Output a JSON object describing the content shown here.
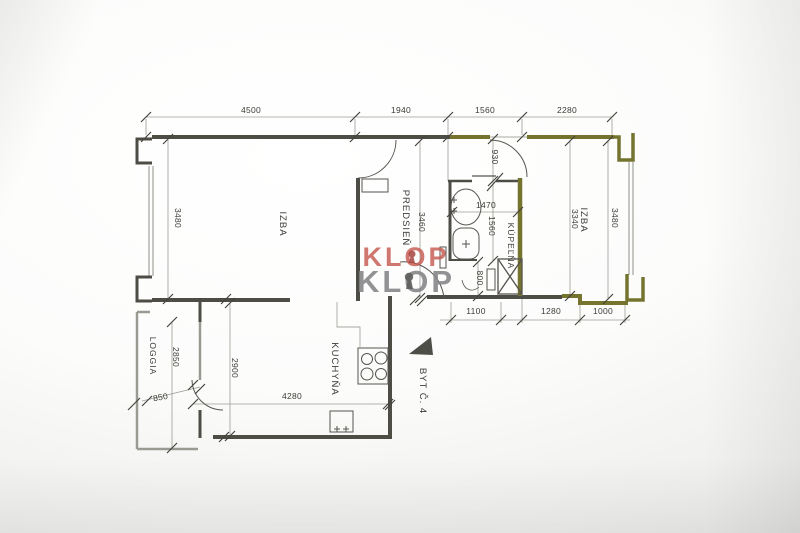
{
  "plan": {
    "unit_label": "BYT Č. 4",
    "rooms": {
      "izba_left": "IZBA",
      "predsien": "PREDSIEŇ",
      "kupelna": "KÚPEĽŇA",
      "izba_right": "IZBA",
      "kuchyna": "KUCHYŇA",
      "loggia": "LOGGIA"
    },
    "dimensions": {
      "top_4500": "4500",
      "top_1940": "1940",
      "top_1560": "1560",
      "top_2280": "2280",
      "left_3480": "3480",
      "predsien_3460": "3460",
      "bath_930": "930",
      "bath_1470": "1470",
      "bath_1560": "1560",
      "bath_800": "800",
      "right_3340": "3340",
      "right_3480": "3480",
      "bottom_1100": "1100",
      "bottom_1280": "1280",
      "bottom_1000": "1000",
      "kitchen_2900": "2900",
      "kitchen_4280": "4280",
      "loggia_2850": "2850",
      "loggia_850": "850"
    },
    "watermark": {
      "line1": "KLOP",
      "line2": "KLOP"
    },
    "colors": {
      "wall_dark": "#4d4c45",
      "wall_olive": "#74742f",
      "watermark_red": "#c75a52",
      "watermark_gray": "#87878a"
    }
  }
}
